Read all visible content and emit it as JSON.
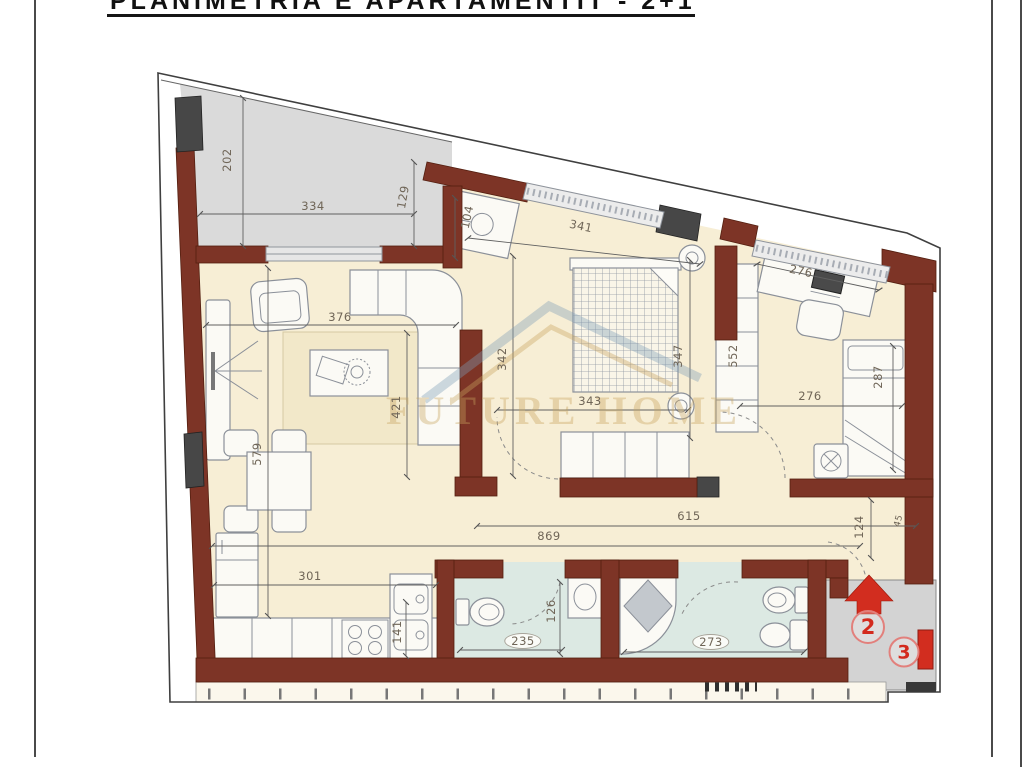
{
  "page": {
    "title": "PLANIMETRIA E APARTAMENTIT - 2+1"
  },
  "watermark": {
    "brand": "FUTURE HOME"
  },
  "entrance": {
    "unit_2": "2",
    "unit_3": "3"
  },
  "dims": {
    "d202": "202",
    "d334": "334",
    "d129": "129",
    "d104": "104",
    "d341": "341",
    "d376": "376",
    "d421": "421",
    "d342": "342",
    "d347": "347",
    "d343": "343",
    "d276_desk": "276",
    "d552": "552",
    "d287": "287",
    "d276_room": "276",
    "d579": "579",
    "d301": "301",
    "d141": "141",
    "d869": "869",
    "d615": "615",
    "d124": "124",
    "d45": "45",
    "d235": "235",
    "d126": "126",
    "d273": "273"
  }
}
